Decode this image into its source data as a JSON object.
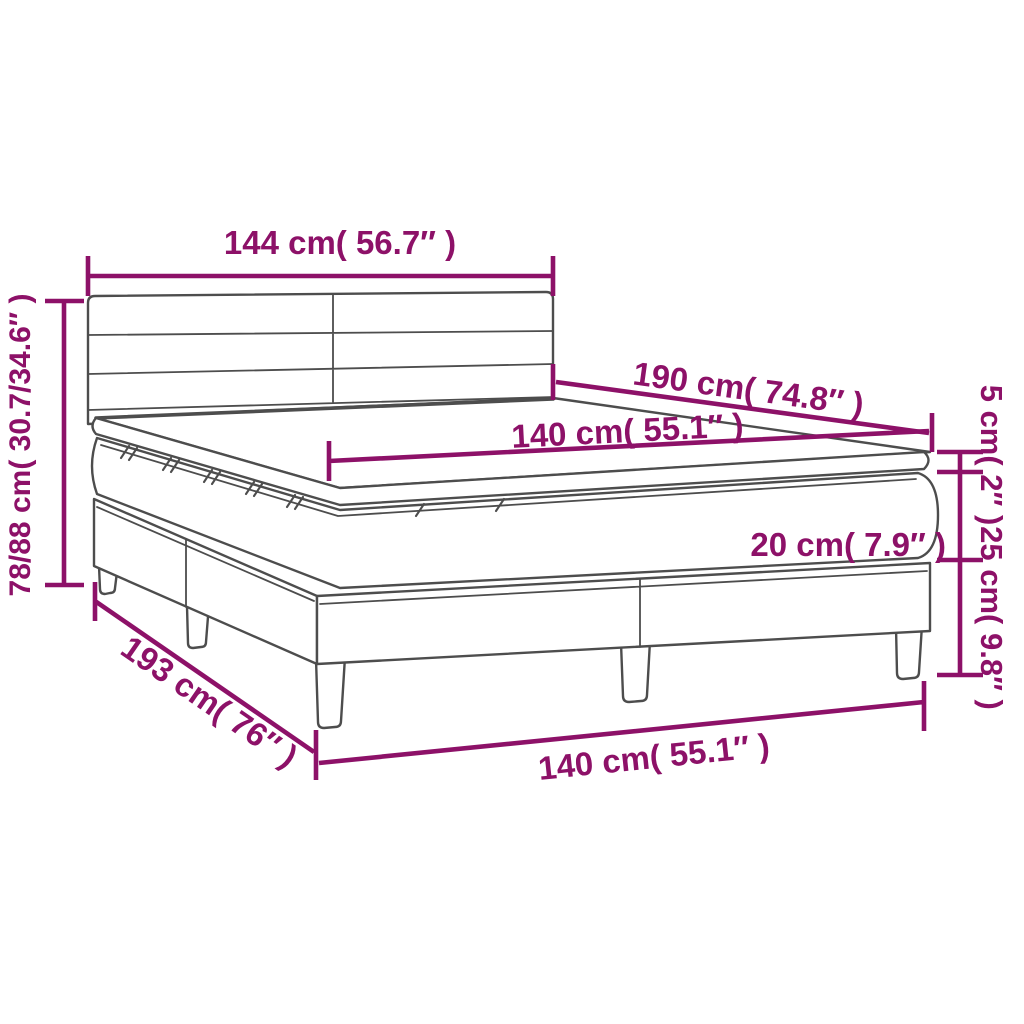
{
  "diagram_title": "Box spring bed with topper — dimension diagram",
  "colors": {
    "dimension_annotation": "#8D1168",
    "product_outline": "#4D4D4D",
    "background": "#FFFFFF"
  },
  "product_parts": [
    "headboard",
    "topper",
    "mattress",
    "box-spring base",
    "legs"
  ],
  "dimensions": {
    "headboard_width": {
      "cm": "144",
      "in": "56.7",
      "label": "144 cm( 56.7″ )"
    },
    "total_height": {
      "cm": "78/88",
      "in": "30.7/34.6",
      "label": "78/88 cm( 30.7/34.6″ )"
    },
    "mattress_length": {
      "cm": "190",
      "in": "74.8",
      "label": "190 cm( 74.8″ )"
    },
    "mattress_width": {
      "cm": "140",
      "in": "55.1",
      "label": "140 cm( 55.1″ )"
    },
    "topper_height": {
      "cm": "5",
      "in": "2",
      "label": "5 cm( 2″ )"
    },
    "mattress_height": {
      "cm": "20",
      "in": "7.9",
      "label": "20 cm( 7.9″ )"
    },
    "base_height": {
      "cm": "25",
      "in": "9.8",
      "label": "25 cm( 9.8″ )"
    },
    "base_length": {
      "cm": "193",
      "in": "76",
      "label": "193 cm( 76″ )"
    },
    "base_width": {
      "cm": "140",
      "in": "55.1",
      "label": "140 cm( 55.1″ )"
    }
  }
}
